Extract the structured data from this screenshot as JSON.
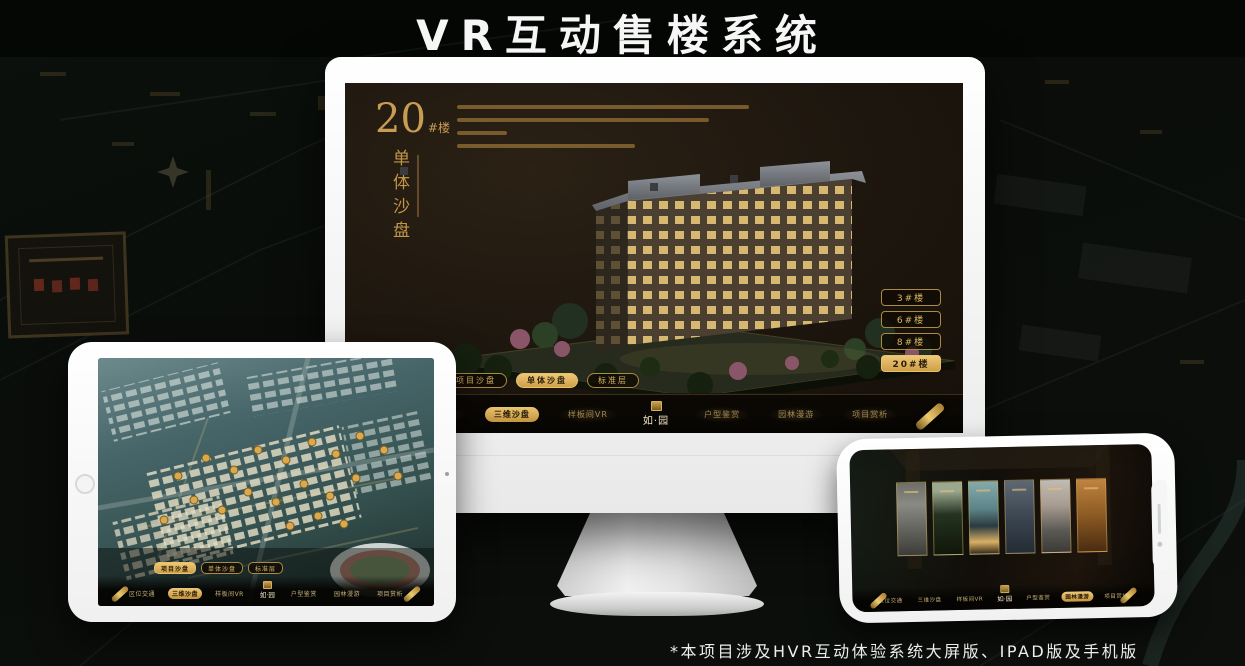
{
  "header": {
    "title": "VR互动售楼系统"
  },
  "footer": {
    "note": "*本项目涉及HVR互动体验系统大屏版、IPAD版及手机版"
  },
  "brand": {
    "logo_text": "如·园"
  },
  "colors": {
    "accent_gold": "#d2a755",
    "active_text": "#2b1d07",
    "screen_bg": "#1d160e"
  },
  "desktop": {
    "heading": {
      "number": "20",
      "suffix": "#楼",
      "subtitle": "单体沙盘"
    },
    "floor_buttons": [
      {
        "label": "3#楼",
        "active": false
      },
      {
        "label": "6#楼",
        "active": false
      },
      {
        "label": "8#楼",
        "active": false
      },
      {
        "label": "20#楼",
        "active": true
      }
    ],
    "tabs": [
      {
        "label": "项目沙盘",
        "active": false
      },
      {
        "label": "单体沙盘",
        "active": true
      },
      {
        "label": "标准层",
        "active": false
      }
    ],
    "nav": [
      {
        "label": "区位交通",
        "active": false
      },
      {
        "label": "三维沙盘",
        "active": true
      },
      {
        "label": "样板间VR",
        "active": false
      },
      {
        "label": "户型鉴赏",
        "active": false
      },
      {
        "label": "园林漫游",
        "active": false
      },
      {
        "label": "项目赏析",
        "active": false
      }
    ]
  },
  "tablet": {
    "tabs": [
      {
        "label": "项目沙盘",
        "active": true
      },
      {
        "label": "单体沙盘",
        "active": false
      },
      {
        "label": "标准层",
        "active": false
      }
    ],
    "nav": [
      {
        "label": "区位交通",
        "active": false
      },
      {
        "label": "三维沙盘",
        "active": true
      },
      {
        "label": "样板间VR",
        "active": false
      },
      {
        "label": "户型鉴赏",
        "active": false
      },
      {
        "label": "园林漫游",
        "active": false
      },
      {
        "label": "项目赏析",
        "active": false
      }
    ]
  },
  "mobile": {
    "nav": [
      {
        "label": "区位交通",
        "active": false
      },
      {
        "label": "三维沙盘",
        "active": false
      },
      {
        "label": "样板间VR",
        "active": false
      },
      {
        "label": "户型鉴赏",
        "active": false
      },
      {
        "label": "园林漫游",
        "active": true
      },
      {
        "label": "项目赏析",
        "active": false
      }
    ]
  }
}
